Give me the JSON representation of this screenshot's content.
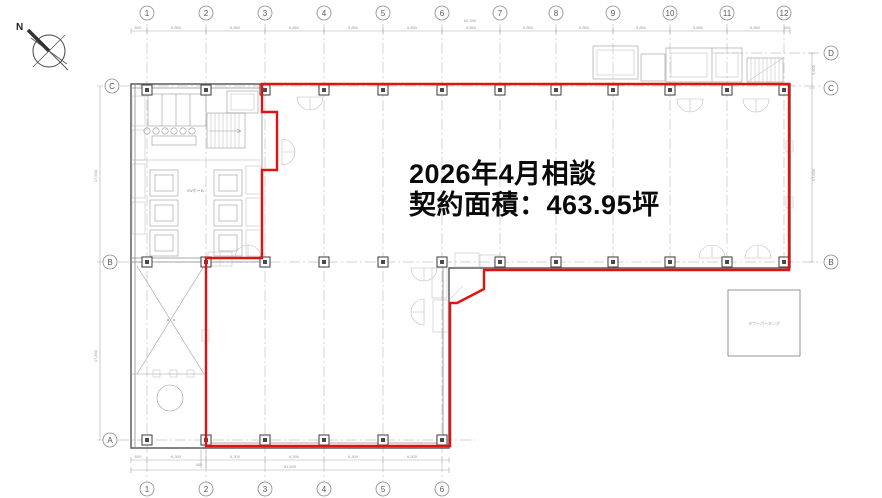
{
  "annotation": {
    "line1": "2026年4月相談",
    "line2": "契約面積：463.95坪"
  },
  "compass": {
    "label": "N"
  },
  "grid": {
    "top": [
      "1",
      "2",
      "3",
      "4",
      "5",
      "6",
      "7",
      "8",
      "9",
      "10",
      "11",
      "12"
    ],
    "bottom": [
      "1",
      "2",
      "3",
      "4",
      "5",
      "6"
    ],
    "left": [
      "C",
      "B",
      "A"
    ],
    "right": [
      "D",
      "C",
      "B"
    ]
  },
  "dims": {
    "top_bay": "5,850",
    "top_total": "60,300",
    "top_end_left": "800",
    "top_end_right": "600",
    "bottom_bay": "6,300",
    "bottom_total": "31,500",
    "bottom_end": "600",
    "bottom_jog": "400",
    "left_upper": "17,600",
    "left_lower": "17,800",
    "right_upper": "3,600",
    "right_lower": "17,600"
  },
  "labels": {
    "parking": "タワーパーキング",
    "ev_hall": "EVホール"
  },
  "colors": {
    "lease_boundary": "#e01212",
    "wall": "#5d5d5d",
    "grid": "#c3c3c3"
  }
}
